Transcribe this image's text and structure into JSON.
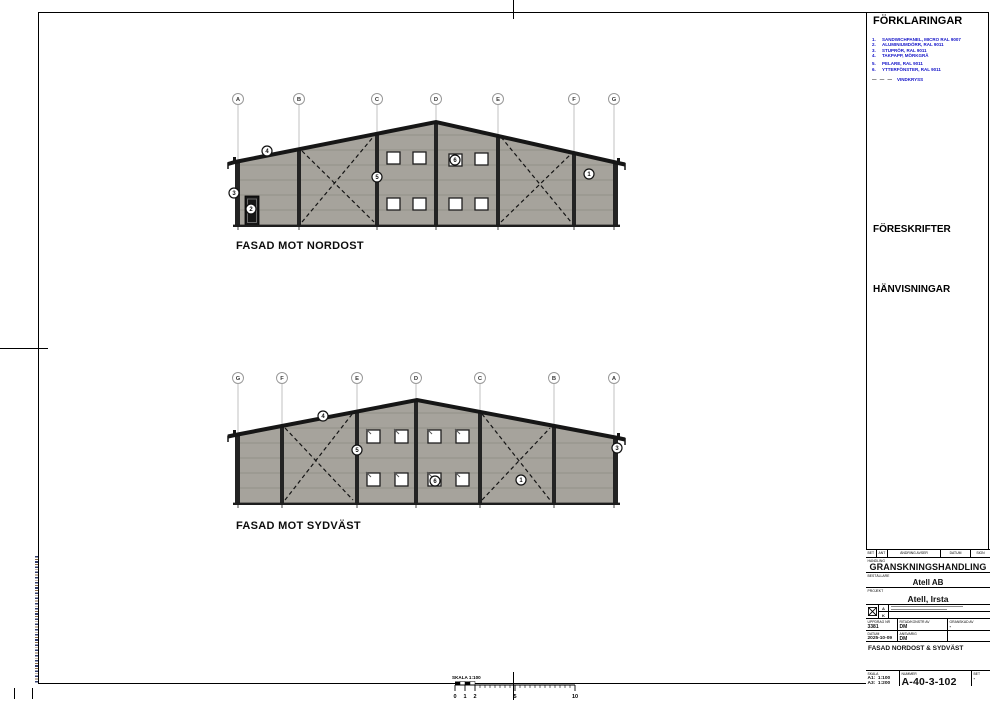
{
  "legend": {
    "title": "FÖRKLARINGAR",
    "items": [
      {
        "num": "1.",
        "text": "SANDWICHPANEL, MICRO RAL 9007"
      },
      {
        "num": "2.",
        "text": "ALUMINIUMDÖRR, RAL 9011"
      },
      {
        "num": "3.",
        "text": "STUPRÖR, RAL 9011"
      },
      {
        "num": "4.",
        "text": "TAKPAPP, MÖRKGRÅ"
      },
      {
        "num": "5.",
        "text": "PELARE, RAL 9011"
      },
      {
        "num": "6.",
        "text": "YTTERFÖNSTER, RAL 9011"
      }
    ],
    "dash_note": "VINDKRYSS",
    "dash_symbol": "— — —"
  },
  "sections": {
    "foreskrifter": "FÖRESKRIFTER",
    "hanvisningar": "HÄNVISNINGAR"
  },
  "facades": {
    "nordost": {
      "label": "FASAD MOT NORDOST",
      "grid": [
        "A",
        "B",
        "C",
        "D",
        "E",
        "F",
        "G"
      ],
      "markers": [
        "4",
        "3",
        "2",
        "5",
        "6",
        "1"
      ]
    },
    "sydvast": {
      "label": "FASAD MOT SYDVÄST",
      "grid": [
        "G",
        "F",
        "E",
        "D",
        "C",
        "B",
        "A"
      ],
      "markers": [
        "4",
        "5",
        "6",
        "1",
        "3"
      ]
    }
  },
  "titleblock": {
    "rev_header": [
      "BET",
      "ANT",
      "ÄNDRING AVSER",
      "DATUM",
      "SIGN"
    ],
    "handling_label": "HANDLING",
    "handling": "GRANSKNINGSHANDLING",
    "bestallare_label": "BESTÄLLARE",
    "bestallare": "Atell AB",
    "projekt_label": "PROJEKT",
    "projekt": "Atell, Irsta",
    "discipline_a": "A",
    "discipline_k": "K",
    "uppdrag_label": "UPPDRAG NR",
    "uppdrag": "3381",
    "ritad_label": "RITAD/KONSTR AV",
    "ritad": "DM",
    "granskad_label": "GRANSKAD AV",
    "granskad": "-",
    "datum_label": "DATUM",
    "datum": "2025-10-09",
    "ansvarig_label": "ANSVARIG",
    "ansvarig": "DM",
    "title": "FASAD NORDOST & SYDVÄST",
    "skala_label": "SKALA",
    "skala_a1": "A1:  1:100",
    "skala_a3": "A3:  1:200",
    "nummer_label": "NUMMER",
    "nummer": "A-40-3-102",
    "bet_label": "BET",
    "bet": "-"
  },
  "scalebar": {
    "label": "SKALA 1:100",
    "ticks": [
      "0",
      "1",
      "2",
      "5",
      "10"
    ]
  },
  "colors": {
    "legend_text": "#1414c8",
    "wall_fill": "#a6a39c",
    "wall_joint_line": "#8d8a82",
    "structure_dark": "#1c1c1c"
  }
}
